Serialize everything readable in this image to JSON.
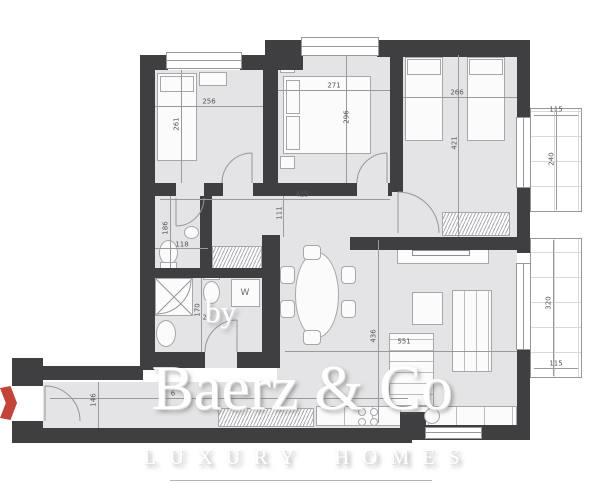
{
  "meta": {
    "type": "apartment floor plan"
  },
  "colors": {
    "wall": "#3f3f41",
    "floor": "#e4e4e6",
    "outline": "#97979b",
    "dim_text": "#55555a",
    "accent_red": "#c2453a"
  },
  "watermark": {
    "prefix": "by",
    "brand": "Baerz & Co",
    "tagline": "LUXURY HOMES"
  },
  "labels": {
    "washing_machine": "W"
  },
  "icons": {
    "left_edge": "red-map-pin-icon"
  },
  "dims": {
    "bedroom1_width": "256",
    "bedroom1_depth": "261",
    "bedroom2_width": "271",
    "bedroom2_depth": "296",
    "bedroom3_width": "266",
    "bedroom3_depth": "421",
    "hall_width": "425",
    "hall_depth": "111",
    "wc_depth": "186",
    "wc_width": "118",
    "bath_depth": "170",
    "bath_offset": "25",
    "living_width": "551",
    "living_depth": "436",
    "entry_depth": "146",
    "entry_width_partial": "6",
    "balcony_top_width": "115",
    "balcony_top_depth": "240",
    "balcony_bottom_depth": "320",
    "balcony_bottom_width": "115"
  }
}
